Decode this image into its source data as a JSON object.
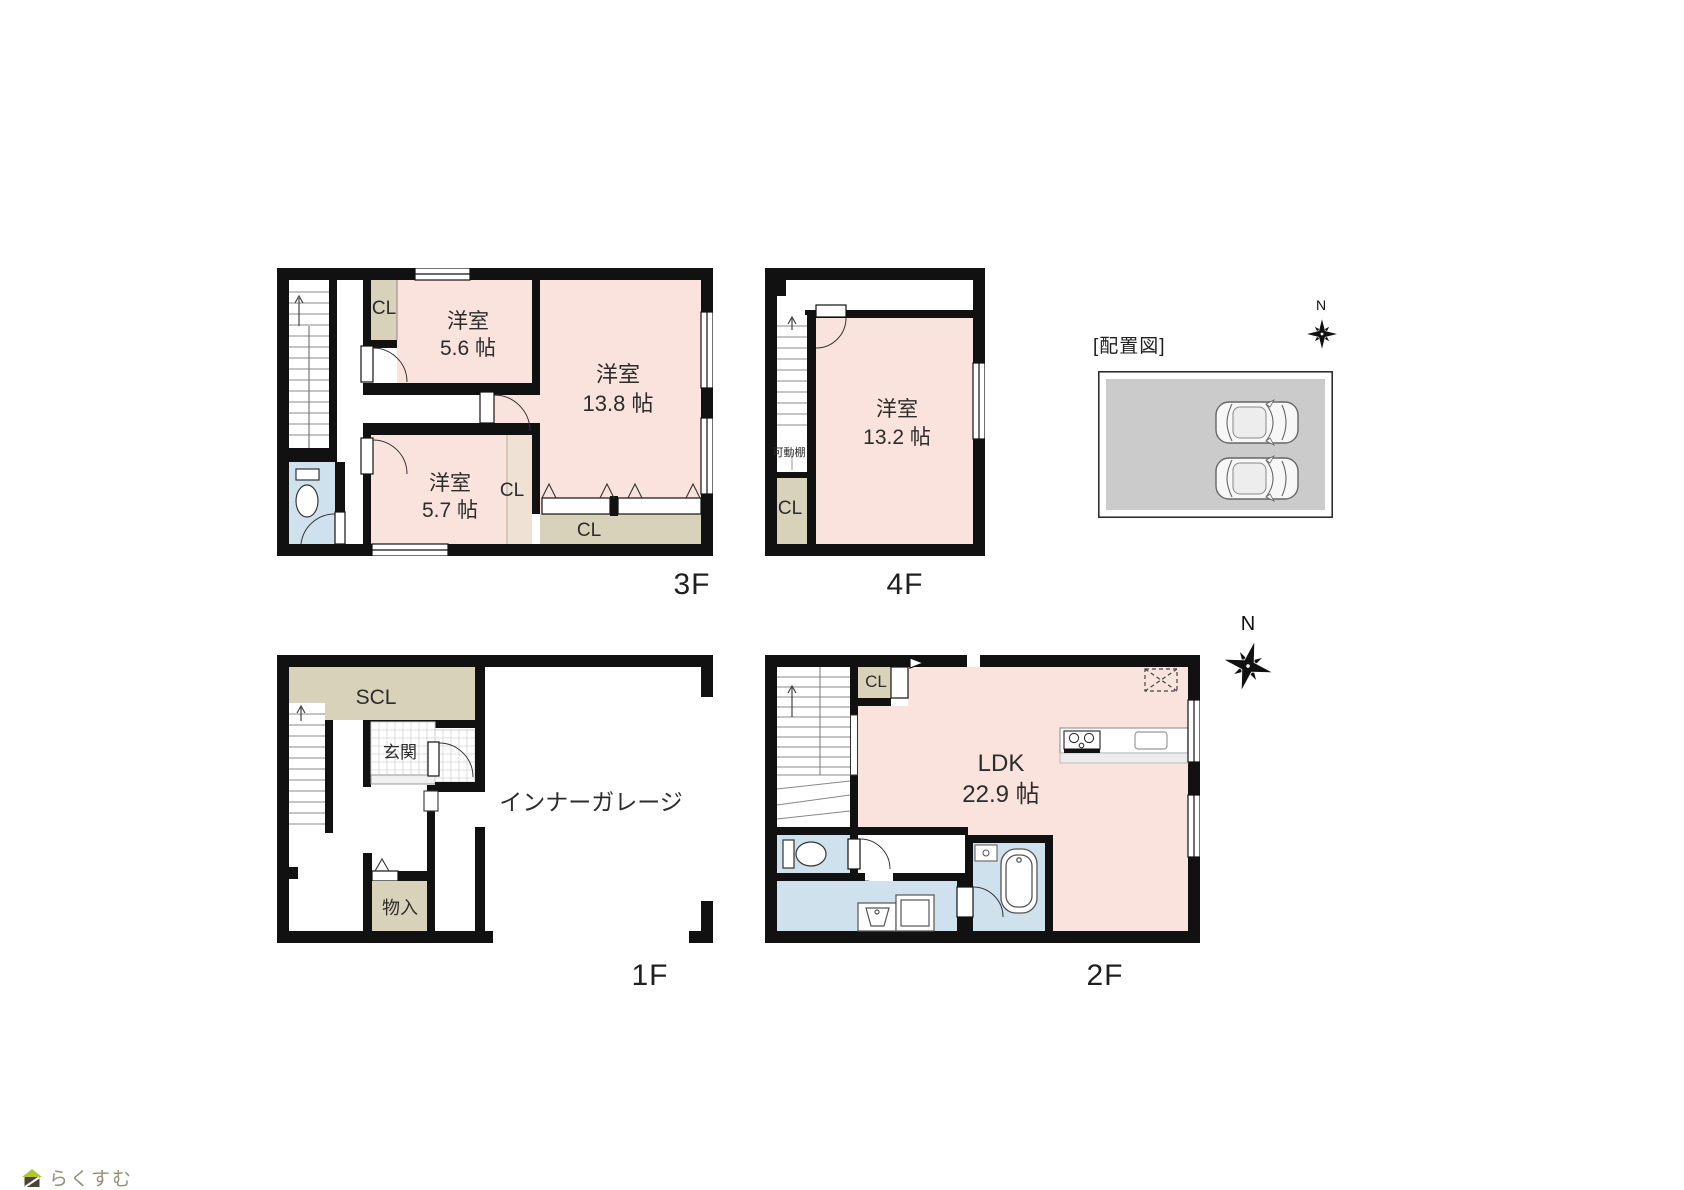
{
  "floors": {
    "f3": {
      "label": "3F",
      "bedroom_a": {
        "name": "洋室",
        "size": "5.6 帖"
      },
      "bedroom_b": {
        "name": "洋室",
        "size": "13.8 帖"
      },
      "bedroom_c": {
        "name": "洋室",
        "size": "5.7 帖"
      },
      "closet_top": "CL",
      "closet_side": "CL",
      "closet_bottom": "CL"
    },
    "f4": {
      "label": "4F",
      "bedroom": {
        "name": "洋室",
        "size": "13.2 帖"
      },
      "shelf": "可動棚",
      "closet": "CL"
    },
    "f1": {
      "label": "1F",
      "shoe_closet": "SCL",
      "entrance": "玄関",
      "garage": "インナーガレージ",
      "storage": "物入"
    },
    "f2": {
      "label": "2F",
      "closet": "CL",
      "ldk": {
        "name": "LDK",
        "size": "22.9 帖"
      }
    }
  },
  "site_plan": {
    "title": "[配置図]"
  },
  "compass": {
    "north_small": "N",
    "north_large": "N"
  },
  "logo": {
    "text": "らくすむ"
  },
  "colors": {
    "wall": "#111111",
    "room_pink": "#f9e3dc",
    "closet_beige": "#d9d2ba",
    "wet_blue": "#cfe1ec",
    "site_gray": "#cbcbcb"
  }
}
